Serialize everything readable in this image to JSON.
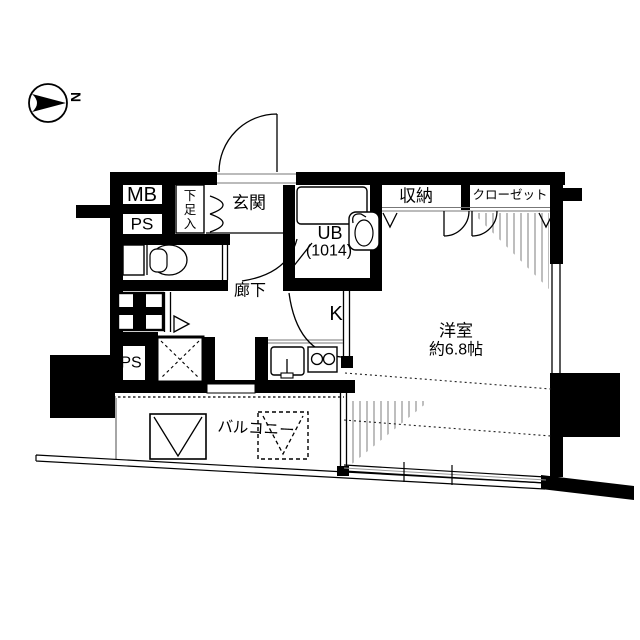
{
  "plan": {
    "title": "apartment-floor-plan",
    "compass": {
      "north": "N"
    },
    "labels": {
      "meter_box": "MB",
      "pipe_space_upper": "PS",
      "shoe_box": "下足入",
      "entrance": "玄関",
      "unit_bath": "UB",
      "unit_bath_size": "(1014)",
      "storage": "収納",
      "closet": "クローゼット",
      "hallway": "廊下",
      "kitchen": "K",
      "pipe_space_lower": "PS",
      "western_room": "洋室",
      "western_room_size": "約6.8帖",
      "balcony": "バルコニー"
    },
    "colors": {
      "wall": "#000000",
      "hatch": "#9a9a9a",
      "thin_line": "#777777"
    }
  }
}
